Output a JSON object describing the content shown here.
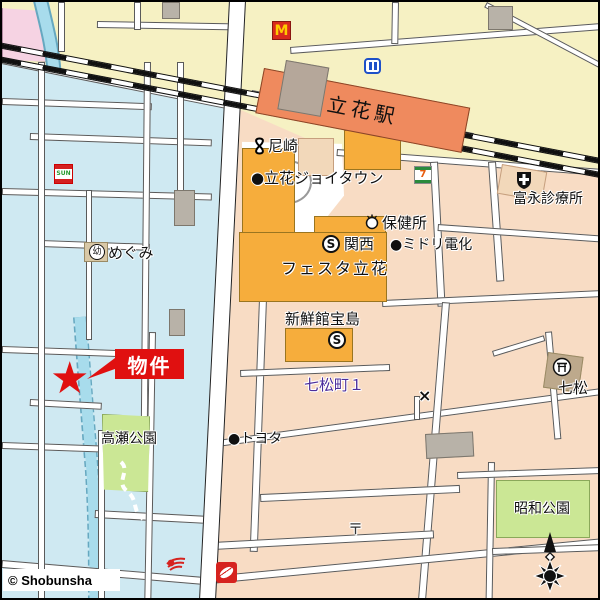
{
  "copyright": "© Shobunsha",
  "station": {
    "name": "立花駅"
  },
  "labels": {
    "amagasaki_shinkin": "尼崎",
    "joytown": "●立花ジョイタウン",
    "tominaga_clinic": "富永診療所",
    "hokensho": "保健所",
    "kansai_super": "関西",
    "midori_denka": "●ミドリ電化",
    "festa_tachibana": "フェスタ立花",
    "megumi": "めぐみ",
    "megumi_symbol": "幼",
    "shinsenkan_takarajima": "新鮮館宝島",
    "nanamatsucho": "七松町１",
    "nanamatsu": "七松",
    "bukken": "物件",
    "star": "★",
    "takase_park": "高瀬公園",
    "toyota": "●トヨタ",
    "showa_park": "昭和公園",
    "post_symbol": "〒",
    "x_symbol": "×",
    "supermarket_symbol": "S",
    "mcdonalds_m": "M",
    "seven_eleven_digit": "7",
    "sun_sign": "SUN"
  },
  "colors": {
    "yellow_area": "#f6f1c3",
    "pink_area": "#f6d3e3",
    "blue_area": "#cfe9f2",
    "salmon_area": "#f8dcc4",
    "river": "#a8dcec",
    "park_green": "#cbe795",
    "building_orange": "#f6ad3c",
    "station_orange": "#ef8a5e",
    "property_red": "#e01010",
    "nanamatsucho_purple": "#4b2d9b"
  }
}
